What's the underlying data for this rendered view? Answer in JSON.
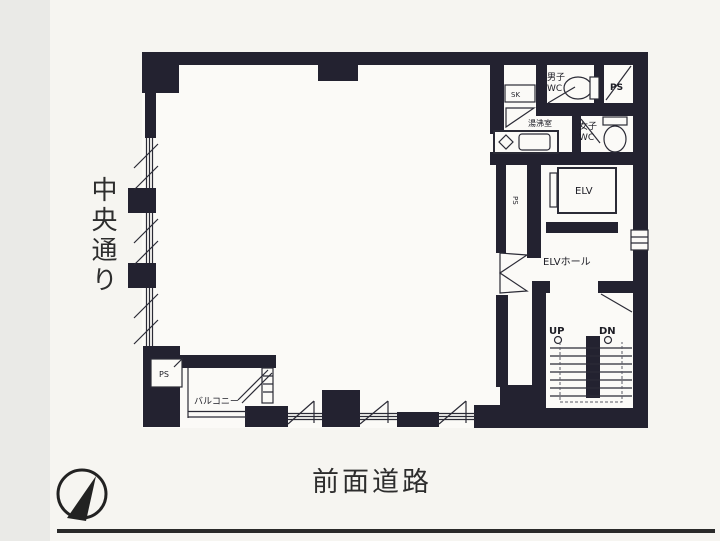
{
  "page": {
    "background_color": "#f6f5f1",
    "left_margin_color": "#eaeae7",
    "wall_color": "#232230",
    "line_color": "#2b2b36"
  },
  "streets": {
    "left_vertical": "中央通り",
    "bottom": "前面道路"
  },
  "plan": {
    "labels": {
      "mens_wc_line1": "男子",
      "mens_wc_line2": "WC",
      "ps_top_right": "PS",
      "sink_closet": "SK",
      "kitchenette": "湯沸室",
      "womens_wc_line1": "女子",
      "womens_wc_line2": "WC",
      "elevator": "ELV",
      "elevator_hall": "ELVホール",
      "pipe_shaft_mid": "PS",
      "stairs_up": "UP",
      "stairs_down": "DN",
      "pipe_shaft_balcony": "PS",
      "balcony": "バルコニー"
    },
    "icons": {
      "compass": "north-compass-icon",
      "toilet": "toilet-icon",
      "sink": "sink-icon",
      "stairs": "staircase",
      "window": "window-glazing"
    }
  }
}
